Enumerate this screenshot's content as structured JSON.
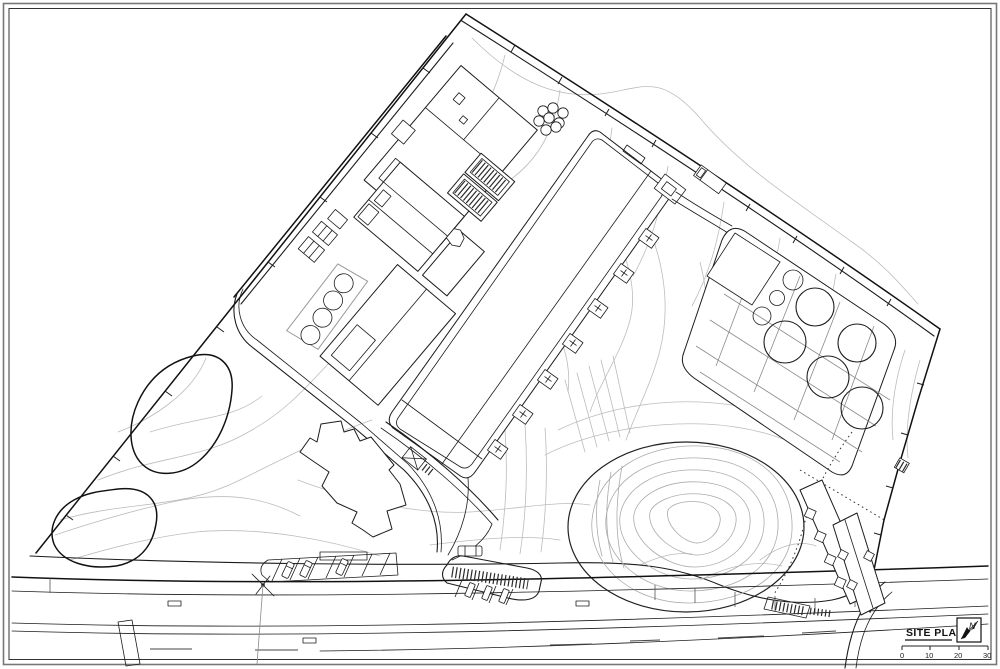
{
  "sheet": {
    "title_block": {
      "title": "SITE PLAN",
      "north_arrow_label": "N",
      "scale_bar": {
        "tick_labels": [
          "0",
          "10",
          "20",
          "30"
        ]
      }
    },
    "colors": {
      "line": "#1c1c1c",
      "heavy_line": "#111111",
      "contour": "#bcbcbc",
      "paper": "#ffffff"
    },
    "features": [
      {
        "name": "sheet-border",
        "type": "double-frame"
      },
      {
        "name": "property-boundary",
        "type": "fence-line-with-ticks"
      },
      {
        "name": "north-access-road",
        "type": "double-line-road"
      },
      {
        "name": "process-building-complex",
        "type": "building-group"
      },
      {
        "name": "clarifier-circles",
        "type": "four-round-tanks"
      },
      {
        "name": "small-digester-cluster",
        "type": "eight-small-circles"
      },
      {
        "name": "aeration-basin",
        "type": "long-rectangular-basin"
      },
      {
        "name": "weir-structures",
        "type": "small-gate-boxes"
      },
      {
        "name": "tank-farm",
        "type": "rounded-pad-with-round-tanks"
      },
      {
        "name": "admin-building",
        "type": "stepped-footprint-building"
      },
      {
        "name": "landscape-ponds",
        "type": "organic-outlines"
      },
      {
        "name": "contour-lines",
        "type": "topography"
      },
      {
        "name": "earth-mound",
        "type": "oval-with-contours"
      },
      {
        "name": "parking-bays",
        "type": "angled-stalls-with-cars"
      },
      {
        "name": "public-road",
        "type": "multi-lane-street"
      },
      {
        "name": "residential-buildings",
        "type": "sawtooth-slabs"
      },
      {
        "name": "utility-pole",
        "type": "pole-with-guy-wires"
      },
      {
        "name": "truck",
        "type": "vehicle-symbol"
      }
    ]
  }
}
